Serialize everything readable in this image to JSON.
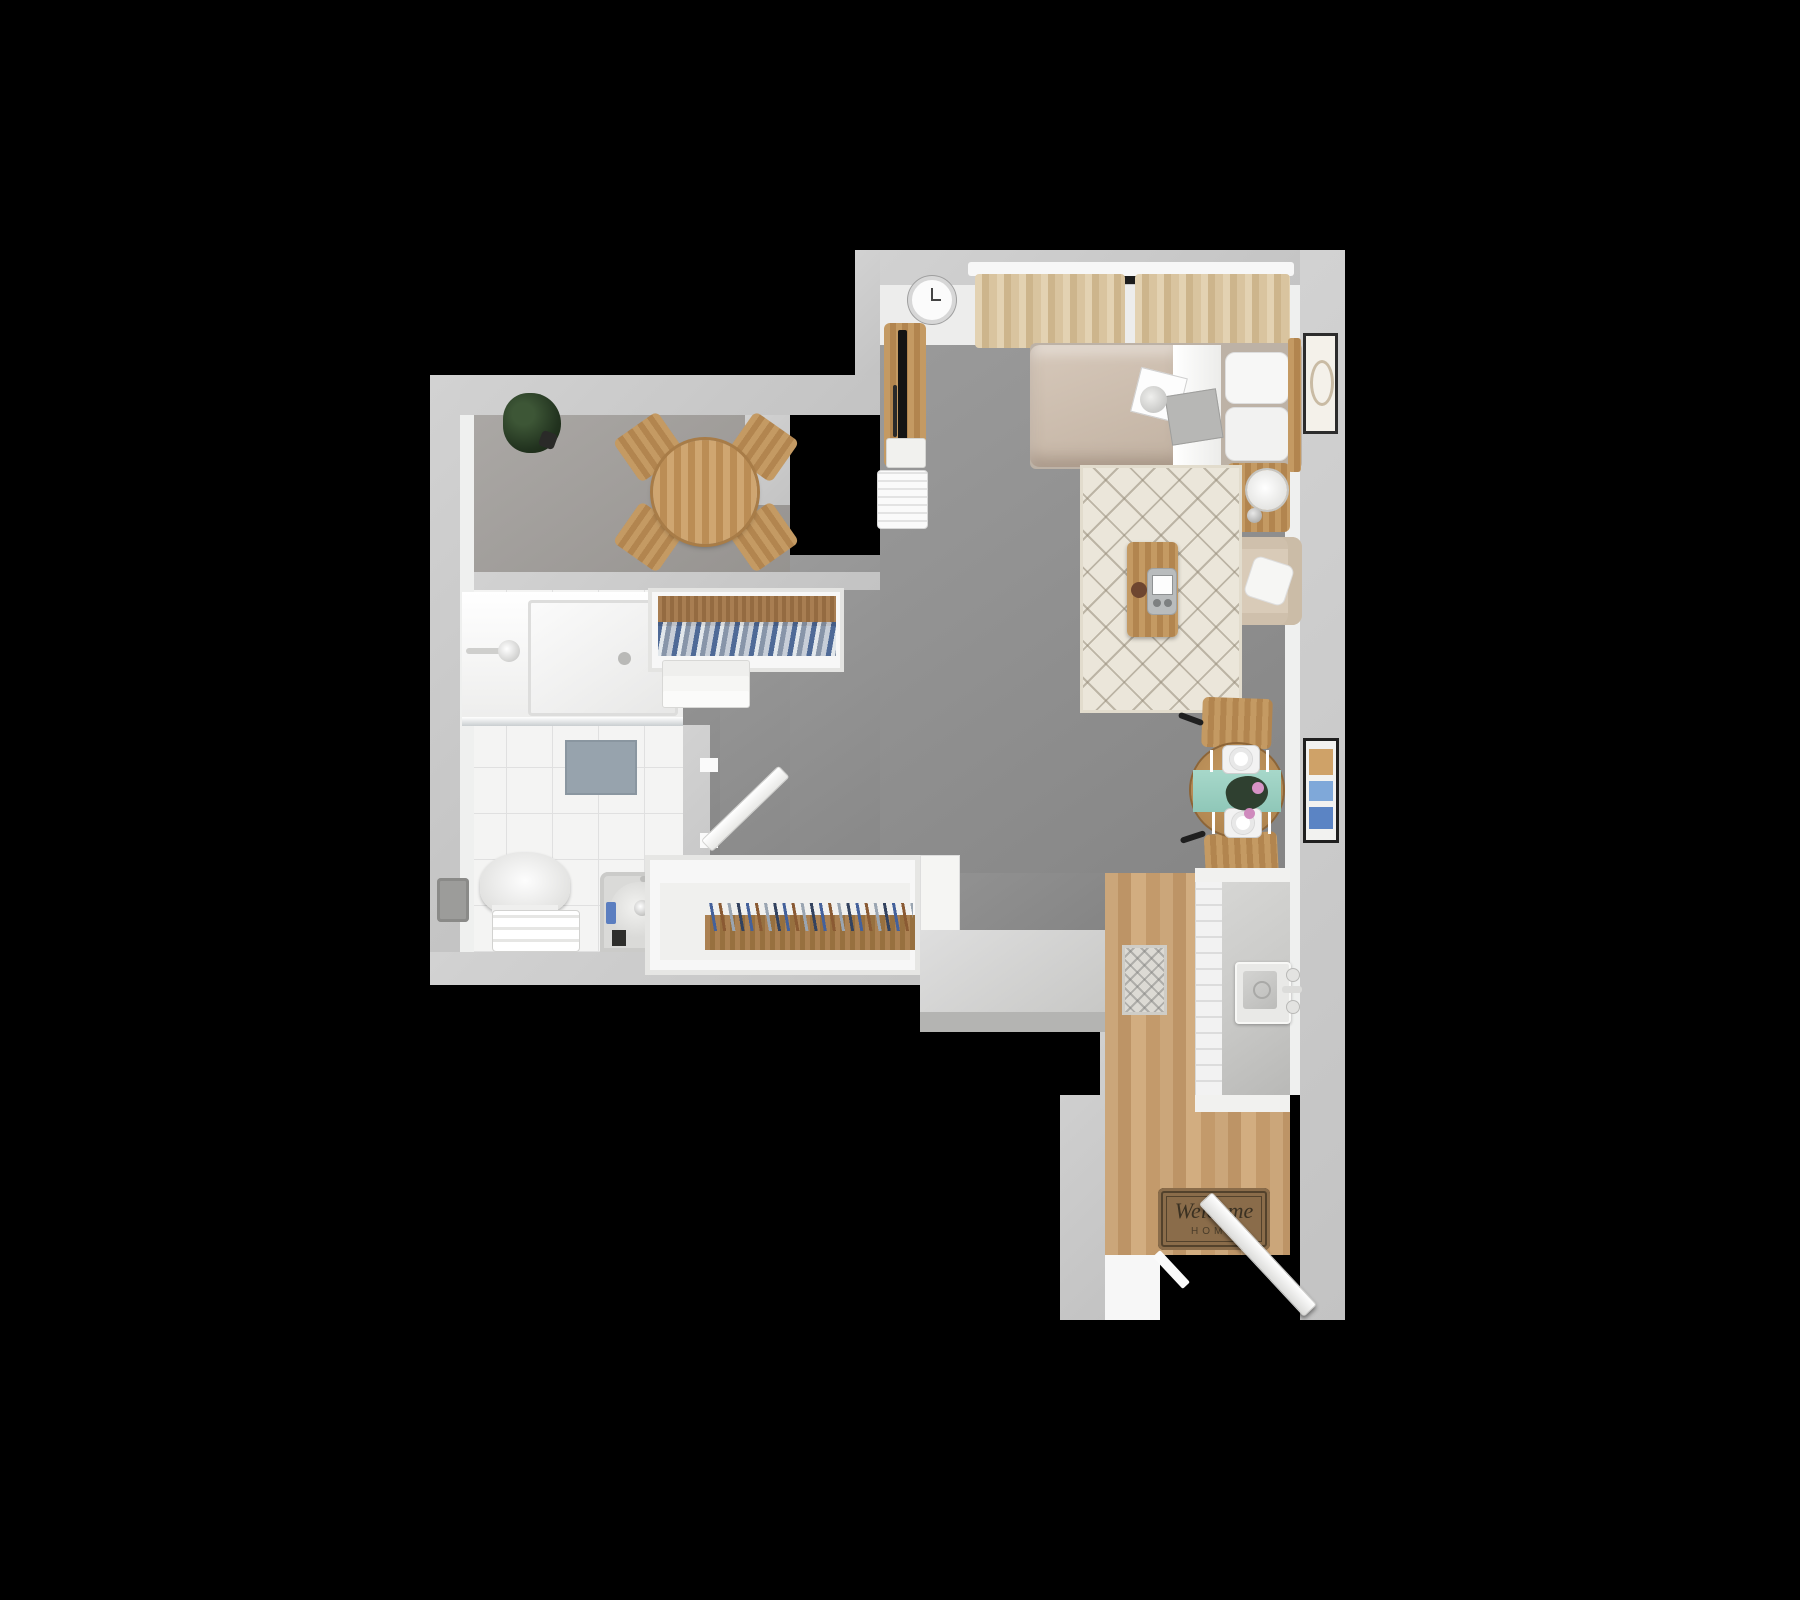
{
  "scene": {
    "description": "top-down 3D render of a studio apartment floor plan on a black background",
    "background_color": "#000000"
  },
  "palette": {
    "wall": "#c9c9c9",
    "wall_inner_face": "#eff0ef",
    "living_carpet": "#8f8f8f",
    "dining_carpet": "#a5a3a0",
    "bathroom_tile": "#f4f4f3",
    "kitchen_wood": "#c49a6c",
    "area_rug_cream": "#ebe6da",
    "bed_duvet": "#cdbfb1",
    "curtain_beige": "#d8c3a1",
    "table_runner_teal": "#9ed0c2",
    "doormat_brown": "#8a6c4a",
    "counter_gray": "#d0d0d0",
    "accent_wood": "#b2854f"
  },
  "doormat": {
    "line1": "Welcome",
    "line2": "HOME"
  },
  "objects": [
    "wall-clock",
    "curtains",
    "windows",
    "tv-console",
    "tv",
    "heater-unit",
    "bed",
    "pillows",
    "duvet",
    "magazines-on-bed",
    "wall-art-bedroom",
    "nightstand",
    "table-lamp",
    "armchair",
    "throw-pillow",
    "area-rug",
    "coffee-table",
    "tabletop-gadget",
    "coaster",
    "bistro-table",
    "bistro-chair-top",
    "bistro-chair-bottom",
    "table-runner",
    "place-settings",
    "flower-centerpiece",
    "wall-art-dining",
    "kitchen-counter",
    "kitchen-sink",
    "refrigerator",
    "kitchen-runner-rug",
    "welcome-doormat",
    "entry-door",
    "dining-table",
    "dining-chairs",
    "potted-plant",
    "walk-in-shower",
    "shower-head",
    "glass-panel",
    "bath-mat",
    "toilet",
    "toilet-paper-holder",
    "towel-bench",
    "bathtub",
    "upper-closet-hanging-clothes",
    "lower-closet-hanging-clothes",
    "dresser",
    "bathroom-door",
    "half-wall-counter"
  ]
}
